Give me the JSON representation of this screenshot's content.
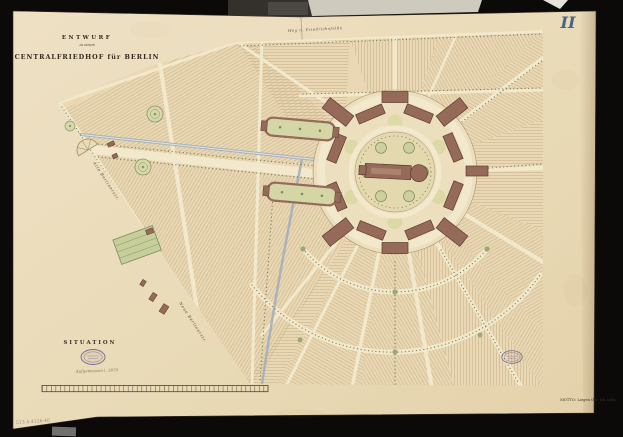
{
  "document": {
    "plate_number": "II",
    "title": {
      "line1": "ENTWURF",
      "line2": "zu einem",
      "line3": "CENTRALFRIEDHOF für BERLIN"
    },
    "section_label": "SITUATION",
    "survey_note": "Aufgemessen i. 1870",
    "motto": "MOTTO: Liegen thu' ich nicht",
    "inventory_number": "513 A 4126-46",
    "stamps": {
      "left": "oval-archive-stamp",
      "right": "oval-archive-stamp"
    }
  },
  "map": {
    "street_labels": {
      "north": "Weg n. Friedrichsfelde",
      "west_upper": "Alte Berlinerstr.",
      "west_lower": "Neue Berlinerstr."
    },
    "features": [
      "central-chapel-ring",
      "radiating-avenues",
      "burial-field-sections",
      "railway-line",
      "entrance-axis-courts",
      "semicircular-entrance-plaza",
      "nursery-garden",
      "scale-bar"
    ]
  },
  "colors": {
    "backdrop": "#0b0a08",
    "paper": "#e9dbba",
    "field_hatch": "#c4ad85",
    "road": "#f2e8cc",
    "building": "#966a59",
    "building_outline": "#5d3b31",
    "greenery": "#8a9466",
    "railway": "#a7b2bb",
    "plate_ink": "#456585",
    "stamp_ink": "#7a6a92"
  }
}
